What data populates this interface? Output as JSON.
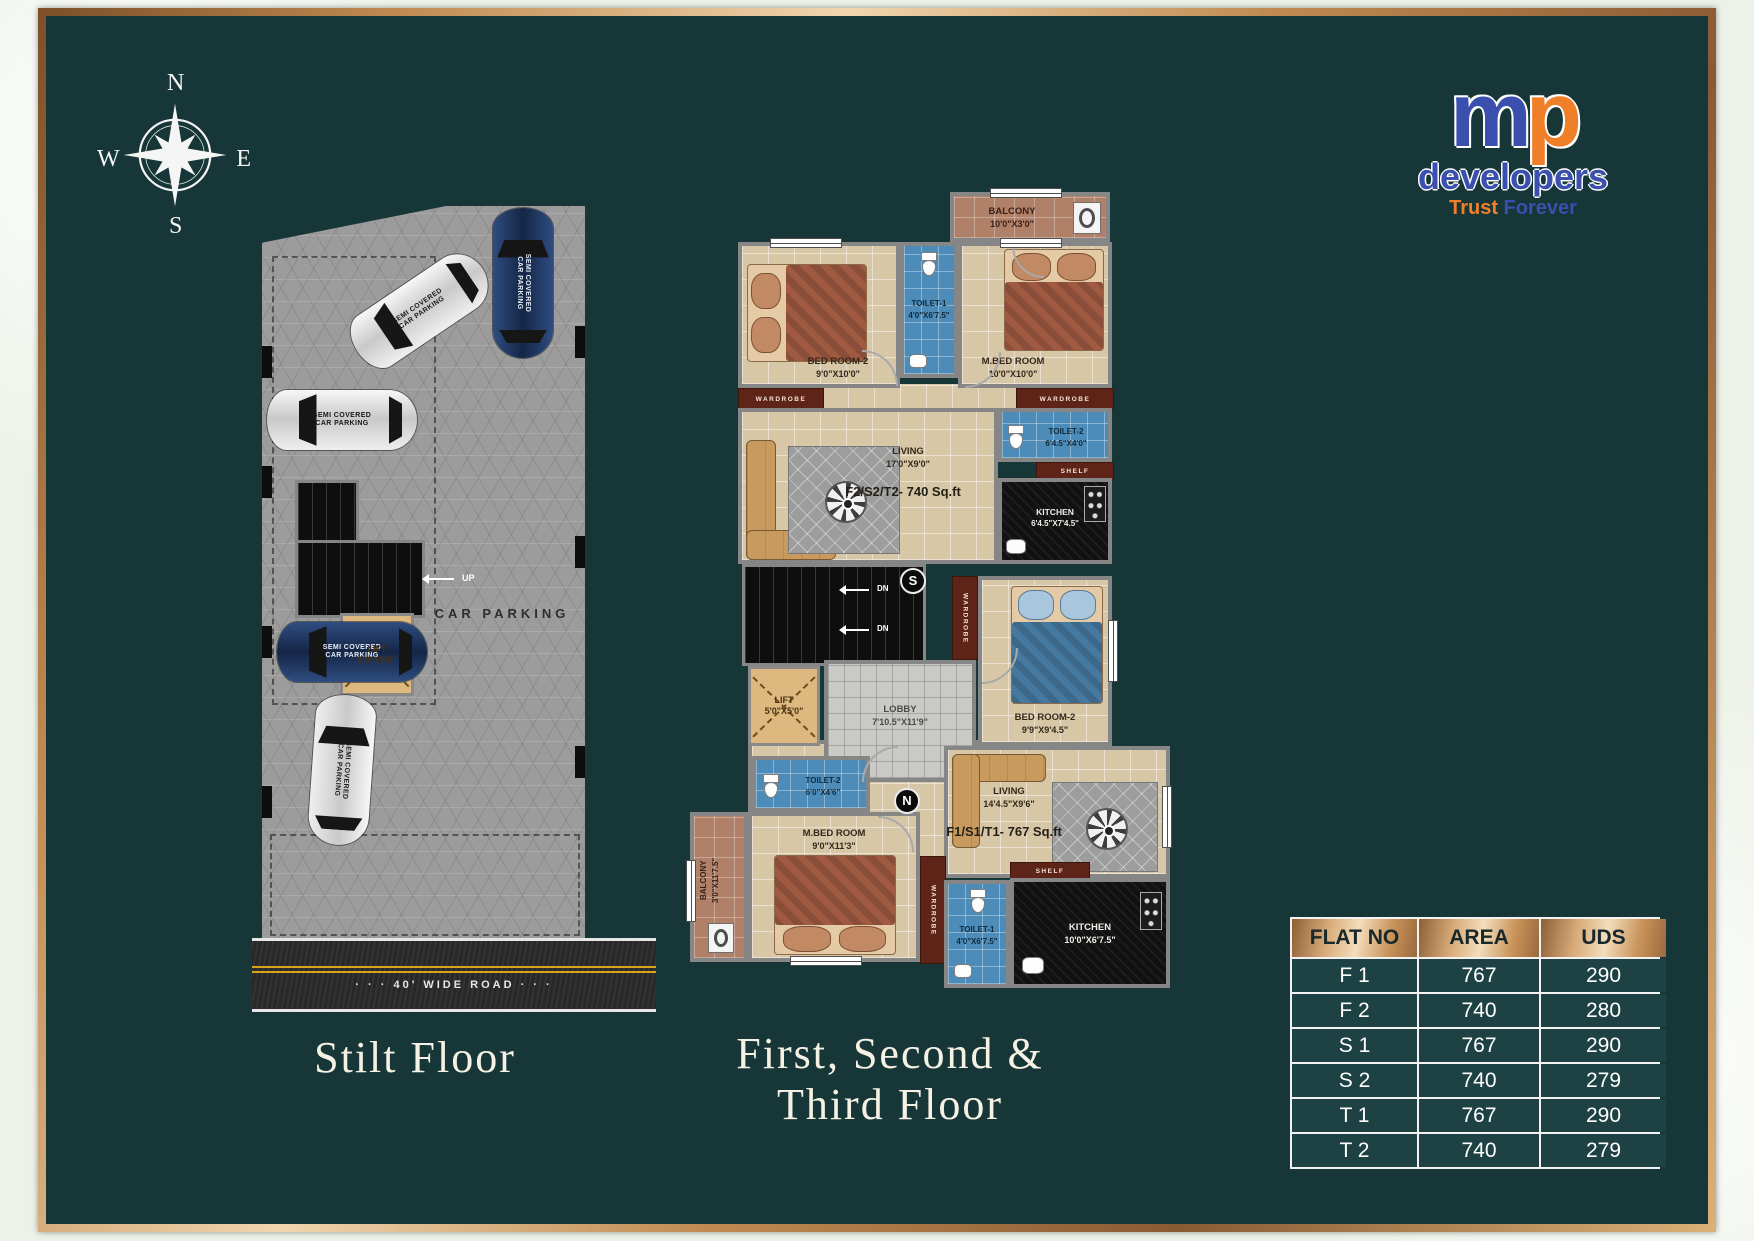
{
  "compass": {
    "n": "N",
    "e": "E",
    "s": "S",
    "w": "W"
  },
  "logo": {
    "m": "m",
    "p": "p",
    "name": "developers",
    "tagline_trust": "Trust",
    "tagline_forever": "Forever",
    "blue": "#3a4fae",
    "orange": "#f07f2a"
  },
  "stilt": {
    "title": "Stilt  Floor",
    "car_parking_label": "CAR PARKING",
    "up_label": "UP",
    "lift_name": "LIFT",
    "lift_size": "5'0\"X5'0\"",
    "road_label": "· · ·  40' WIDE ROAD  · · ·",
    "car_line1": "SEMI COVERED",
    "car_line2": "CAR PARKING"
  },
  "plan": {
    "title_line1": "First, Second &",
    "title_line2": "Third  Floor",
    "unit_upper": "F2/S2/T2- 740 Sq.ft",
    "unit_lower": "F1/S1/T1- 767 Sq.ft",
    "wardrobe": "WARDROBE",
    "shelf": "SHELF",
    "dn": "DN",
    "badge_s": "S",
    "badge_n": "N",
    "rooms": [
      {
        "name": "BALCONY",
        "size": "10'0\"X3'0\""
      },
      {
        "name": "BED ROOM-2",
        "size": "9'0\"X10'0\""
      },
      {
        "name": "TOILET-1",
        "size": "4'0\"X6'7.5\""
      },
      {
        "name": "M.BED ROOM",
        "size": "10'0\"X10'0\""
      },
      {
        "name": "TOILET-2",
        "size": "6'4.5\"X4'0\""
      },
      {
        "name": "KITCHEN",
        "size": "6'4.5\"X7'4.5\""
      },
      {
        "name": "LIVING",
        "size": "17'0\"X9'0\""
      },
      {
        "name": "LIFT",
        "size": "5'0\"X5'0\""
      },
      {
        "name": "LOBBY",
        "size": "7'10.5\"X11'9\""
      },
      {
        "name": "BED ROOM-2",
        "size": "9'9\"X9'4.5\""
      },
      {
        "name": "TOILET-2",
        "size": "6'0\"X4'6\""
      },
      {
        "name": "LIVING",
        "size": "14'4.5\"X9'6\""
      },
      {
        "name": "M.BED ROOM",
        "size": "9'0\"X11'3\""
      },
      {
        "name": "BALCONY",
        "size": "3'0\"X11'7.5\""
      },
      {
        "name": "TOILET-1",
        "size": "4'0\"X6'7.5\""
      },
      {
        "name": "KITCHEN",
        "size": "10'0\"X6'7.5\""
      }
    ]
  },
  "table": {
    "headers": [
      "FLAT NO",
      "AREA",
      "UDS"
    ],
    "rows": [
      [
        "F 1",
        "767",
        "290"
      ],
      [
        "F 2",
        "740",
        "280"
      ],
      [
        "S 1",
        "767",
        "290"
      ],
      [
        "S 2",
        "740",
        "279"
      ],
      [
        "T 1",
        "767",
        "290"
      ],
      [
        "T 2",
        "740",
        "279"
      ]
    ]
  },
  "colors": {
    "panel": "#173637",
    "frame_copper": "#c08a52"
  }
}
